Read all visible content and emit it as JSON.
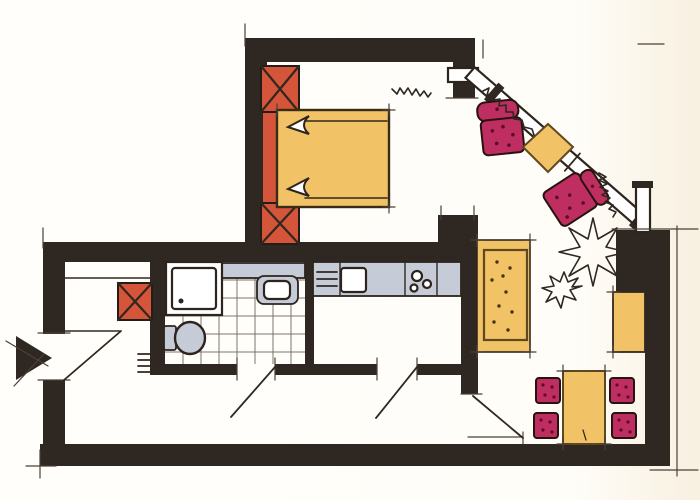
{
  "meta": {
    "title": "Hand-drawn apartment floor plan sketch",
    "style": "marker and ink drawing, no text labels visible"
  },
  "palette": {
    "wall": "#2f2721",
    "paper": "#fffdf8",
    "wardrobe_red": "#d4553a",
    "furniture_yellow": "#f1c366",
    "upholstery_magenta": "#bf2e60",
    "fixture_gray": "#c6cbd8",
    "ink": "#30281f"
  },
  "rooms": {
    "bedroom": "Bedroom",
    "bathroom": "Bathroom (tiled)",
    "kitchen": "Kitchen",
    "hallway": "Entrance hall",
    "living": "Living / dining area"
  },
  "labels": {
    "plan": "Apartment floor plan",
    "bed": "Double bed with two pillows",
    "wardrobe": "Built-in wardrobe with X end cabinets",
    "hall_closet": "Hall closet (X cabinet)",
    "closet_front": "Hall wardrobe front lines",
    "entrance_arrow": "Entrance direction arrow",
    "entrance_door": "Entrance door swing",
    "radiator": "Radiator ticks",
    "shower": "Shower tray",
    "toilet": "Toilet",
    "washbasin": "Washbasin on counter",
    "bath_counter": "Bathroom counter",
    "tile_floor": "Bathroom tile grid",
    "kitchen_counter": "Kitchen counter",
    "kitchen_sink": "Kitchen sink",
    "cooktop": "Cooktop burners",
    "drainer": "Drainer / grill lines",
    "bathroom_door": "Bathroom door swing",
    "kitchen_door": "Kitchen door swing",
    "living_door": "Living room door swing",
    "corner_window": "Diagonal corner window band",
    "window_stub_h": "Window segment (horizontal)",
    "window_stub_v": "Window segment (vertical)",
    "curtains": "Curtain squiggles",
    "plant": "Plant scribble",
    "armchair_1": "Armchair 1",
    "armchair_2": "Armchair 2 (rotated)",
    "side_table": "Diamond side table",
    "sofa": "Sofa / daybed",
    "desk": "Wall desk",
    "dining_table": "Dining table",
    "dining_chair": "Dining chair",
    "ticks": "Sketch extension ticks"
  },
  "counts": {
    "dining_chairs": 4,
    "armchairs": 2,
    "x_cabinets": 3,
    "door_swings": 4
  }
}
